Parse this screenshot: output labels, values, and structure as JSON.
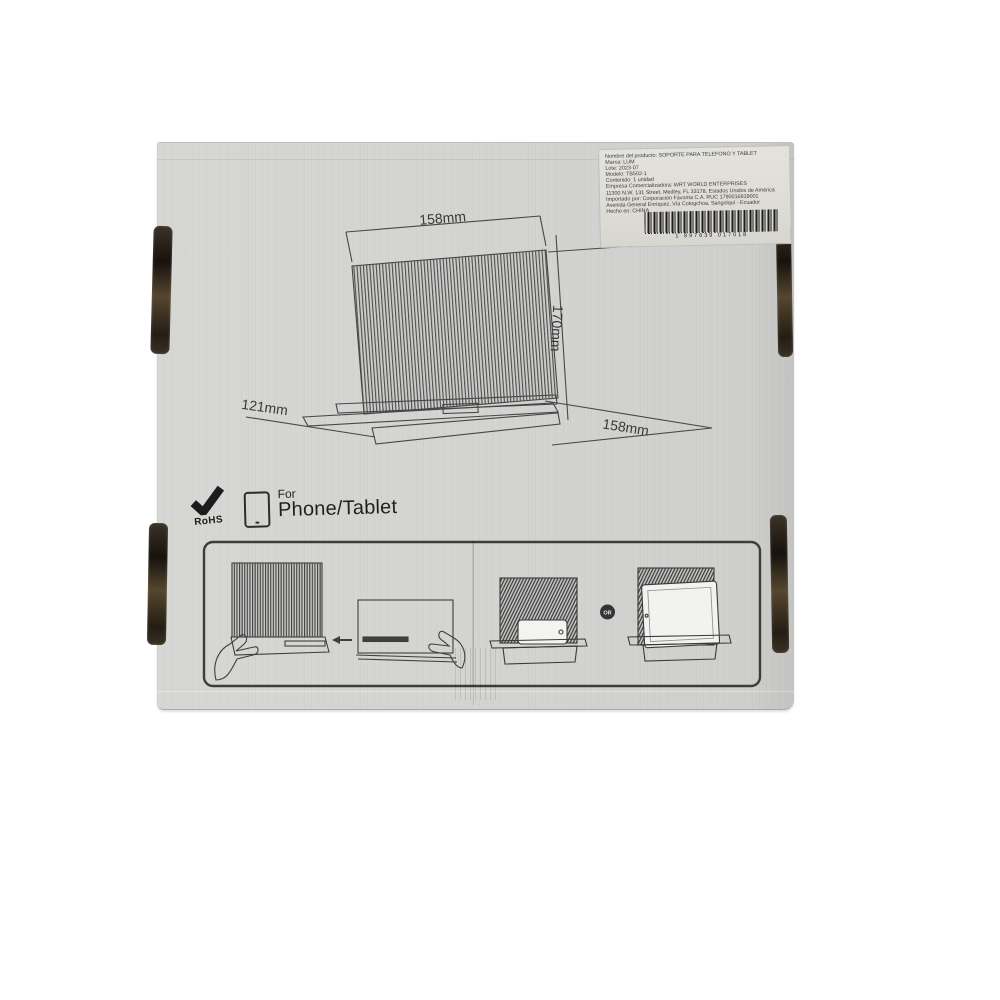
{
  "scene": {
    "description": "Back panel of cardboard retail box for a folding phone and tablet stand",
    "background_color": "#ffffff",
    "box_color": "#d3d3d1",
    "line_color": "#454545"
  },
  "diagram": {
    "dim_top_width": "158mm",
    "dim_height": "170mm",
    "dim_depth": "121mm",
    "dim_bottom_width": "158mm"
  },
  "badges": {
    "rohs_label": "RoHS",
    "for_label": "For",
    "device_label": "Phone/Tablet"
  },
  "instructions": {
    "or_label": "OR"
  },
  "label": {
    "lines": [
      "Nombre del producto: SOPORTE PARA TELEFONO Y TABLET",
      "Marca: LUM",
      "Lote: 2023-07",
      "Modelo: TB502-1",
      "Contenido: 1 unidad",
      "Empresa Comercializadora: WRT WORLD ENTERPRISES",
      "11300 N.W. 131 Street, Medley, FL 33178, Estados Unidos de América",
      "Importado por: Corporación Favorita C.A.  RUC 1790016919001",
      "Avenida General Enríquez, Vía Cotogchoa, Sangolquí - Ecuador",
      "Hecho en: CHINA"
    ],
    "barcode_digits": "1 897639 017018"
  }
}
